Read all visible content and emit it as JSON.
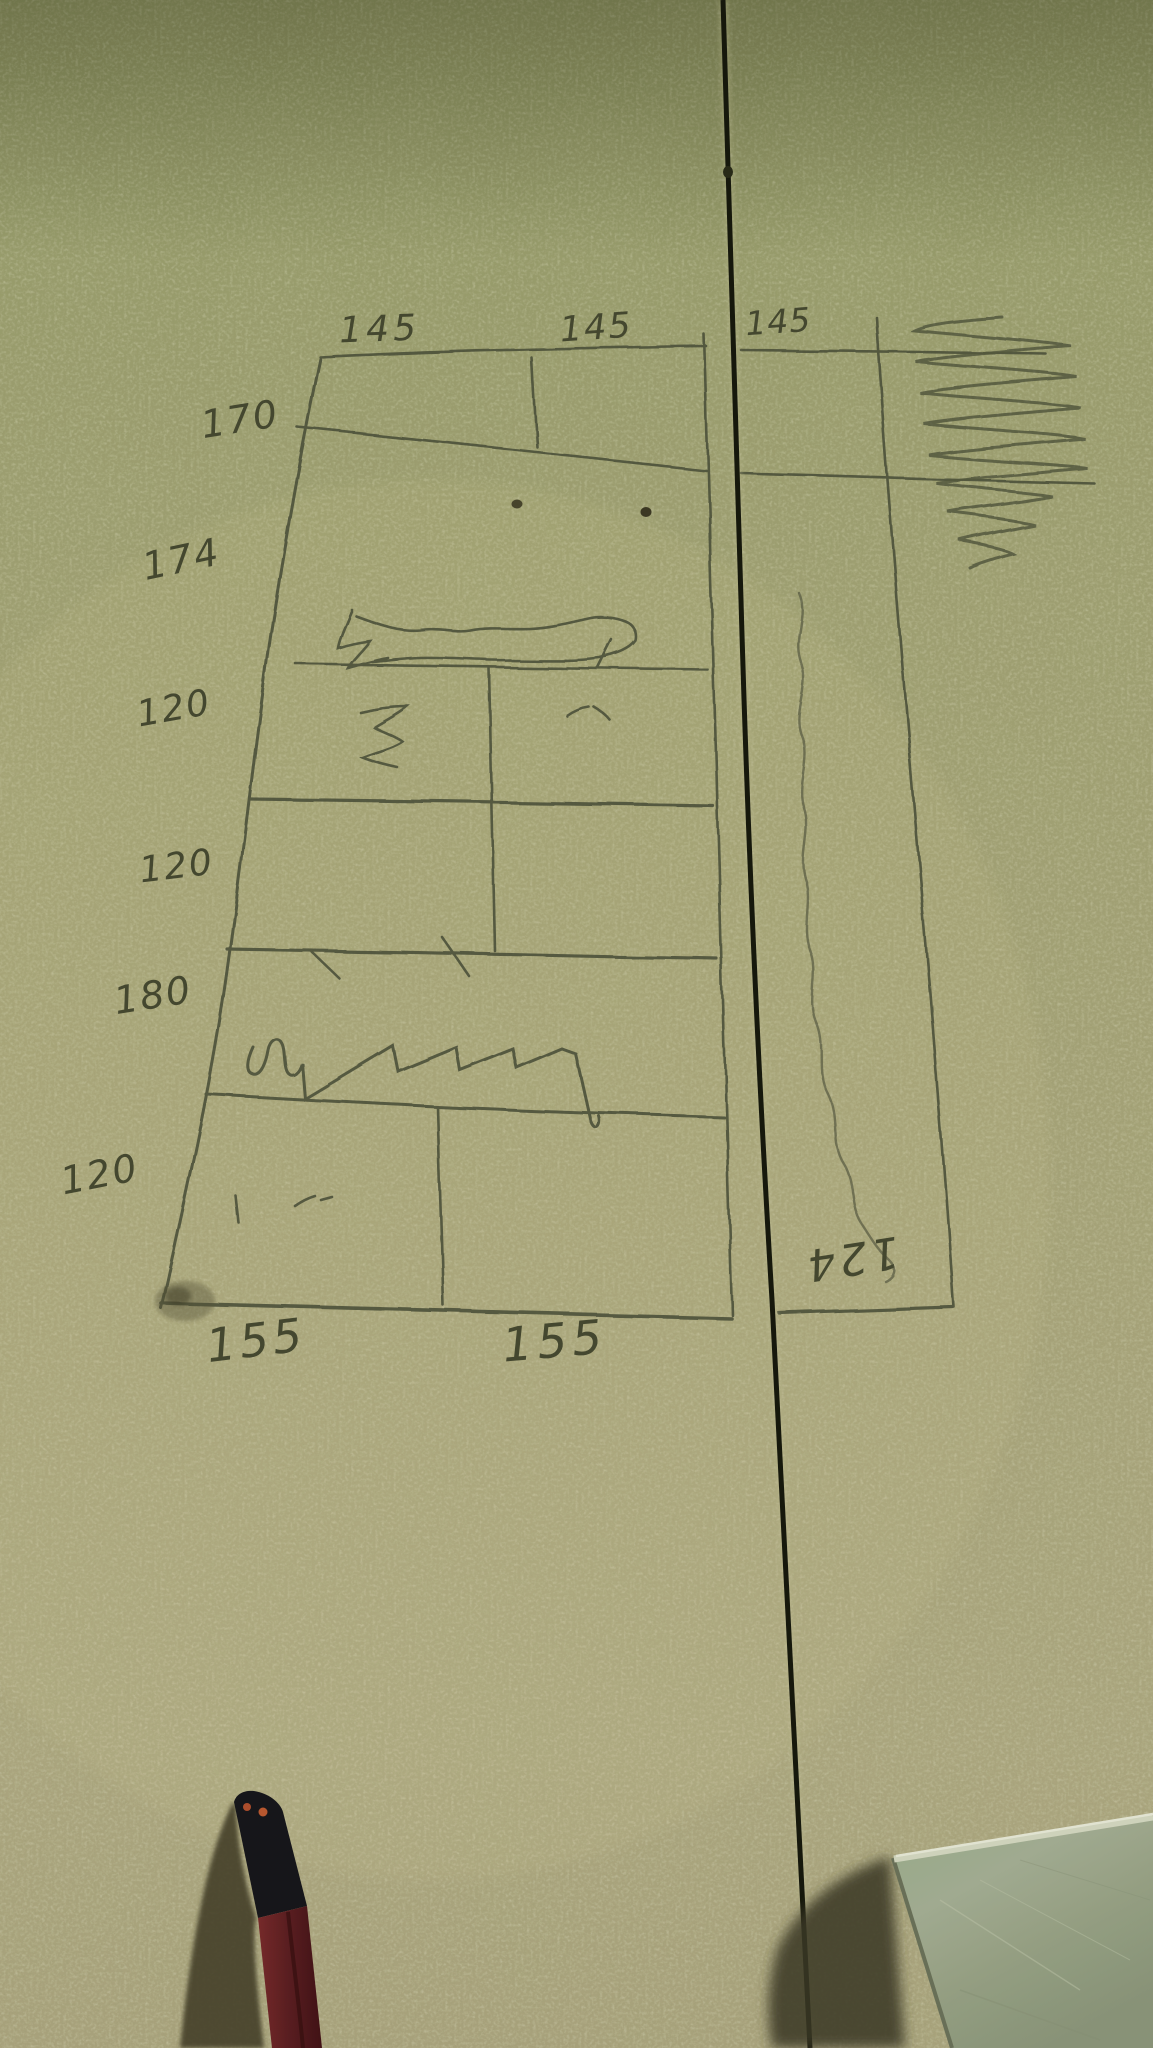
{
  "board": {
    "base_color": "#a6a678",
    "kerf_color": "#17190c",
    "pencil_line_color": "#4e523a"
  },
  "sketch": {
    "top_labels": [
      {
        "text": "145"
      },
      {
        "text": "145"
      },
      {
        "text": "145"
      }
    ],
    "left_labels": [
      {
        "text": "170"
      },
      {
        "text": "174"
      },
      {
        "text": "120"
      },
      {
        "text": "120"
      },
      {
        "text": "180"
      },
      {
        "text": "120"
      }
    ],
    "bottom_labels": [
      {
        "text": "155"
      },
      {
        "text": "155"
      }
    ],
    "right_label": {
      "text": "124"
    }
  },
  "objects": {
    "pencil": {
      "body_color": "#5f1f22",
      "tip_color": "#17171b",
      "dot_color": "#b5512e"
    },
    "metal_square": {
      "color": "#a7b195",
      "edge_highlight": "#e2e6d2"
    }
  }
}
